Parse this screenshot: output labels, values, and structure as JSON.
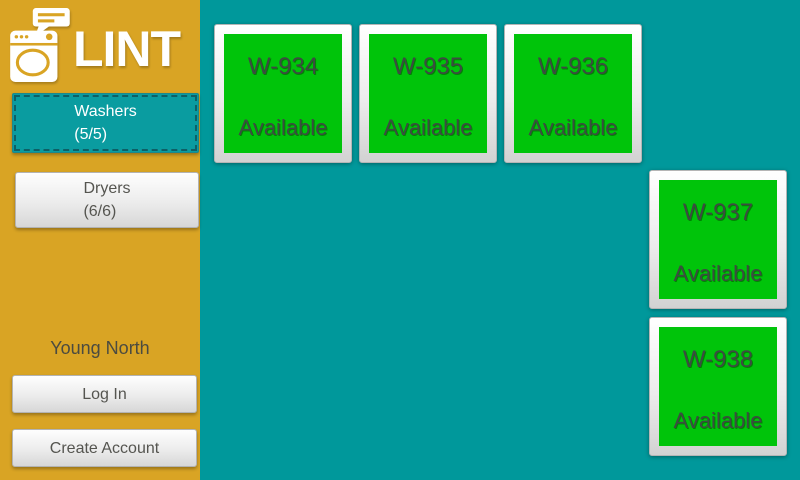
{
  "app": {
    "title": "LINT"
  },
  "colors": {
    "sidebar_bg": "#D9A424",
    "board_bg": "#00989B",
    "available_green": "#00C40A",
    "selected_tab_teal": "#0A9CA0"
  },
  "sidebar": {
    "logo_text": "LINT",
    "washers_button": {
      "label": "Washers",
      "count": "(5/5)"
    },
    "dryers_button": {
      "label": "Dryers",
      "count": "(6/6)"
    },
    "location": "Young North",
    "login_label": "Log In",
    "create_account_label": "Create Account"
  },
  "board": {
    "machines": [
      {
        "name": "W-934",
        "status": "Available",
        "col": 1,
        "row": 1
      },
      {
        "name": "W-935",
        "status": "Available",
        "col": 2,
        "row": 1
      },
      {
        "name": "W-936",
        "status": "Available",
        "col": 3,
        "row": 1
      },
      {
        "name": "W-937",
        "status": "Available",
        "col": 4,
        "row": 2
      },
      {
        "name": "W-938",
        "status": "Available",
        "col": 4,
        "row": 3
      }
    ]
  },
  "icons": {
    "logo": "washing-machine-with-speech-bubble"
  }
}
